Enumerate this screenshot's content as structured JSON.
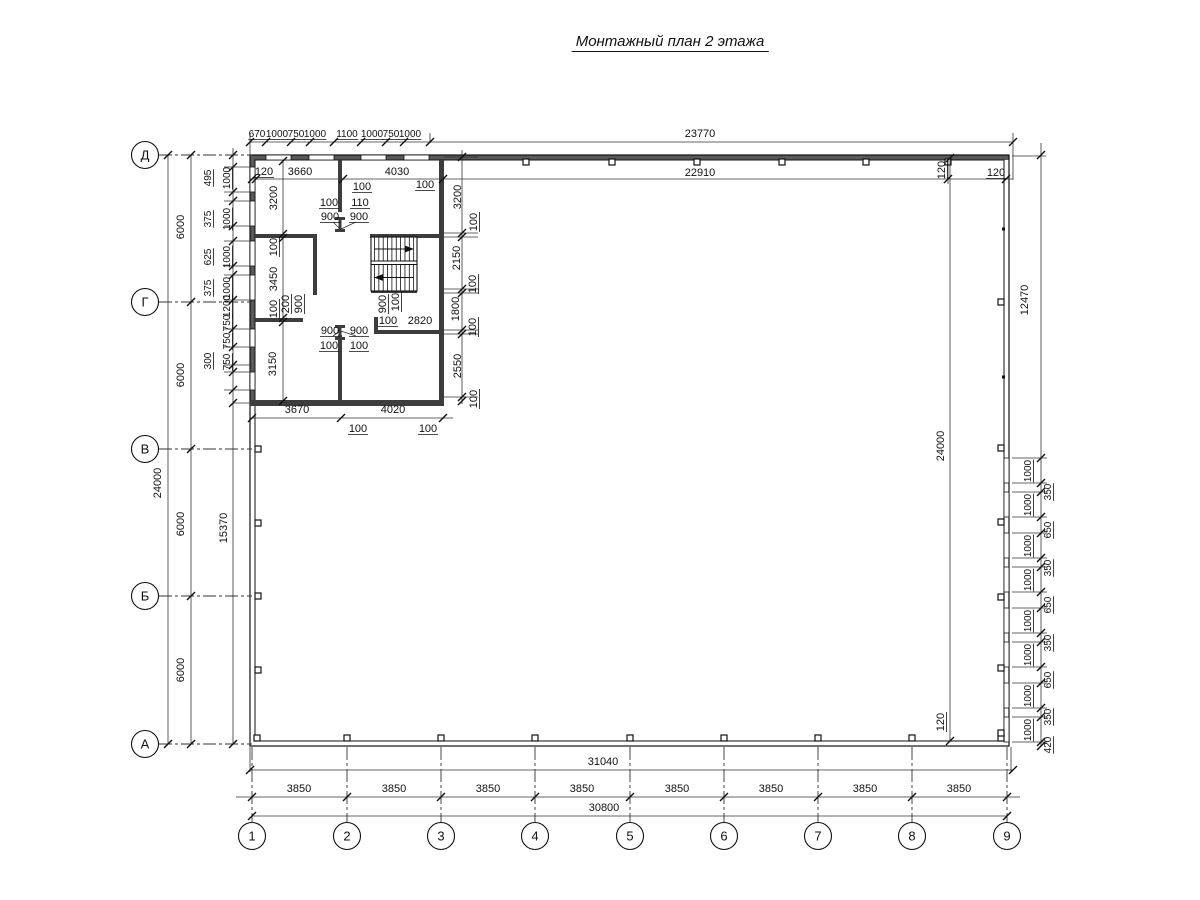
{
  "title": "Монтажный план 2 этажа",
  "axes": {
    "rows": [
      [
        "Д",
        155
      ],
      [
        "Г",
        302
      ],
      [
        "В",
        449
      ],
      [
        "Б",
        596
      ],
      [
        "А",
        744
      ]
    ],
    "cols": [
      [
        "1",
        252
      ],
      [
        "2",
        347
      ],
      [
        "3",
        441
      ],
      [
        "4",
        535
      ],
      [
        "5",
        630
      ],
      [
        "6",
        724
      ],
      [
        "7",
        818
      ],
      [
        "8",
        912
      ],
      [
        "9",
        1007
      ]
    ]
  },
  "dim_texts": [
    [
      "670",
      257,
      137,
      6
    ],
    [
      "1000",
      277,
      137,
      6
    ],
    [
      "750",
      296,
      137,
      6
    ],
    [
      "1000",
      315,
      137,
      6
    ],
    [
      "1100",
      347,
      137,
      6
    ],
    [
      "1000",
      372,
      137,
      6
    ],
    [
      "750",
      391,
      137,
      6
    ],
    [
      "1000",
      410,
      137,
      6
    ],
    [
      "23770",
      700,
      137,
      0
    ],
    [
      "120",
      264,
      175,
      2
    ],
    [
      "3660",
      300,
      175,
      0
    ],
    [
      "4030",
      397,
      175,
      0
    ],
    [
      "22910",
      700,
      176,
      0
    ],
    [
      "120",
      996,
      176,
      2
    ],
    [
      "120",
      945,
      170,
      3
    ],
    [
      "100",
      362,
      190,
      2
    ],
    [
      "100",
      425,
      188,
      2
    ],
    [
      "100",
      329,
      206,
      2
    ],
    [
      "110",
      360,
      206,
      2
    ],
    [
      "900",
      330,
      220,
      2
    ],
    [
      "900",
      359,
      220,
      2
    ],
    [
      "3200",
      277,
      198,
      1
    ],
    [
      "100",
      277,
      247,
      3
    ],
    [
      "3450",
      277,
      279,
      1
    ],
    [
      "100",
      277,
      309,
      3
    ],
    [
      "3150",
      276,
      364,
      1
    ],
    [
      "200",
      289,
      304,
      3
    ],
    [
      "900",
      302,
      304,
      3
    ],
    [
      "900",
      386,
      304,
      3
    ],
    [
      "100",
      399,
      302,
      3
    ],
    [
      "100",
      388,
      324,
      2
    ],
    [
      "2820",
      420,
      324,
      0
    ],
    [
      "900",
      330,
      334,
      2
    ],
    [
      "900",
      359,
      334,
      2
    ],
    [
      "100",
      329,
      349,
      2
    ],
    [
      "100",
      359,
      349,
      2
    ],
    [
      "3200",
      461,
      197,
      1
    ],
    [
      "100",
      477,
      222,
      3
    ],
    [
      "2150",
      460,
      258,
      1
    ],
    [
      "100",
      476,
      284,
      3
    ],
    [
      "1800",
      459,
      309,
      1
    ],
    [
      "100",
      476,
      327,
      3
    ],
    [
      "2550",
      461,
      366,
      1
    ],
    [
      "100",
      477,
      399,
      3
    ],
    [
      "495",
      211,
      178,
      7
    ],
    [
      "1000",
      230,
      178,
      7
    ],
    [
      "375",
      211,
      219,
      7
    ],
    [
      "1000",
      230,
      219,
      7
    ],
    [
      "625",
      211,
      257,
      7
    ],
    [
      "1000",
      230,
      257,
      7
    ],
    [
      "375",
      211,
      288,
      7
    ],
    [
      "1000",
      230,
      288,
      7
    ],
    [
      "1200",
      230,
      306,
      7
    ],
    [
      "750",
      230,
      323,
      7
    ],
    [
      "750",
      230,
      341,
      7
    ],
    [
      "300",
      211,
      361,
      7
    ],
    [
      "750",
      230,
      362,
      7
    ],
    [
      "24000",
      161,
      483,
      1
    ],
    [
      "6000",
      184,
      227,
      1
    ],
    [
      "6000",
      184,
      375,
      1
    ],
    [
      "6000",
      184,
      524,
      1
    ],
    [
      "6000",
      184,
      670,
      1
    ],
    [
      "15370",
      227,
      528,
      1
    ],
    [
      "3670",
      297,
      413,
      0
    ],
    [
      "4020",
      393,
      413,
      0
    ],
    [
      "100",
      358,
      432,
      2
    ],
    [
      "100",
      428,
      432,
      2
    ],
    [
      "12470",
      1028,
      300,
      1
    ],
    [
      "24000",
      944,
      446,
      1
    ],
    [
      "120",
      944,
      722,
      3
    ],
    [
      "1000",
      1031,
      471,
      7
    ],
    [
      "350",
      1051,
      492,
      7
    ],
    [
      "1000",
      1031,
      505,
      7
    ],
    [
      "650",
      1051,
      530,
      7
    ],
    [
      "1000",
      1031,
      546,
      7
    ],
    [
      "350",
      1051,
      568,
      7
    ],
    [
      "1000",
      1031,
      580,
      7
    ],
    [
      "650",
      1051,
      605,
      7
    ],
    [
      "1000",
      1031,
      621,
      7
    ],
    [
      "350",
      1051,
      643,
      7
    ],
    [
      "1000",
      1031,
      655,
      7
    ],
    [
      "650",
      1051,
      680,
      7
    ],
    [
      "1000",
      1031,
      696,
      7
    ],
    [
      "350",
      1051,
      717,
      7
    ],
    [
      "1000",
      1031,
      730,
      7
    ],
    [
      "420",
      1051,
      745,
      7
    ],
    [
      "31040",
      603,
      765,
      0
    ],
    [
      "3850",
      299,
      792,
      0
    ],
    [
      "3850",
      394,
      792,
      0
    ],
    [
      "3850",
      488,
      792,
      0
    ],
    [
      "3850",
      582,
      792,
      0
    ],
    [
      "3850",
      677,
      792,
      0
    ],
    [
      "3850",
      771,
      792,
      0
    ],
    [
      "3850",
      865,
      792,
      0
    ],
    [
      "3850",
      959,
      792,
      0
    ],
    [
      "30800",
      604,
      811,
      0
    ]
  ],
  "colors": {
    "line": "#111111",
    "dim": "#333333",
    "wall_fill": "#5a5a5a"
  }
}
